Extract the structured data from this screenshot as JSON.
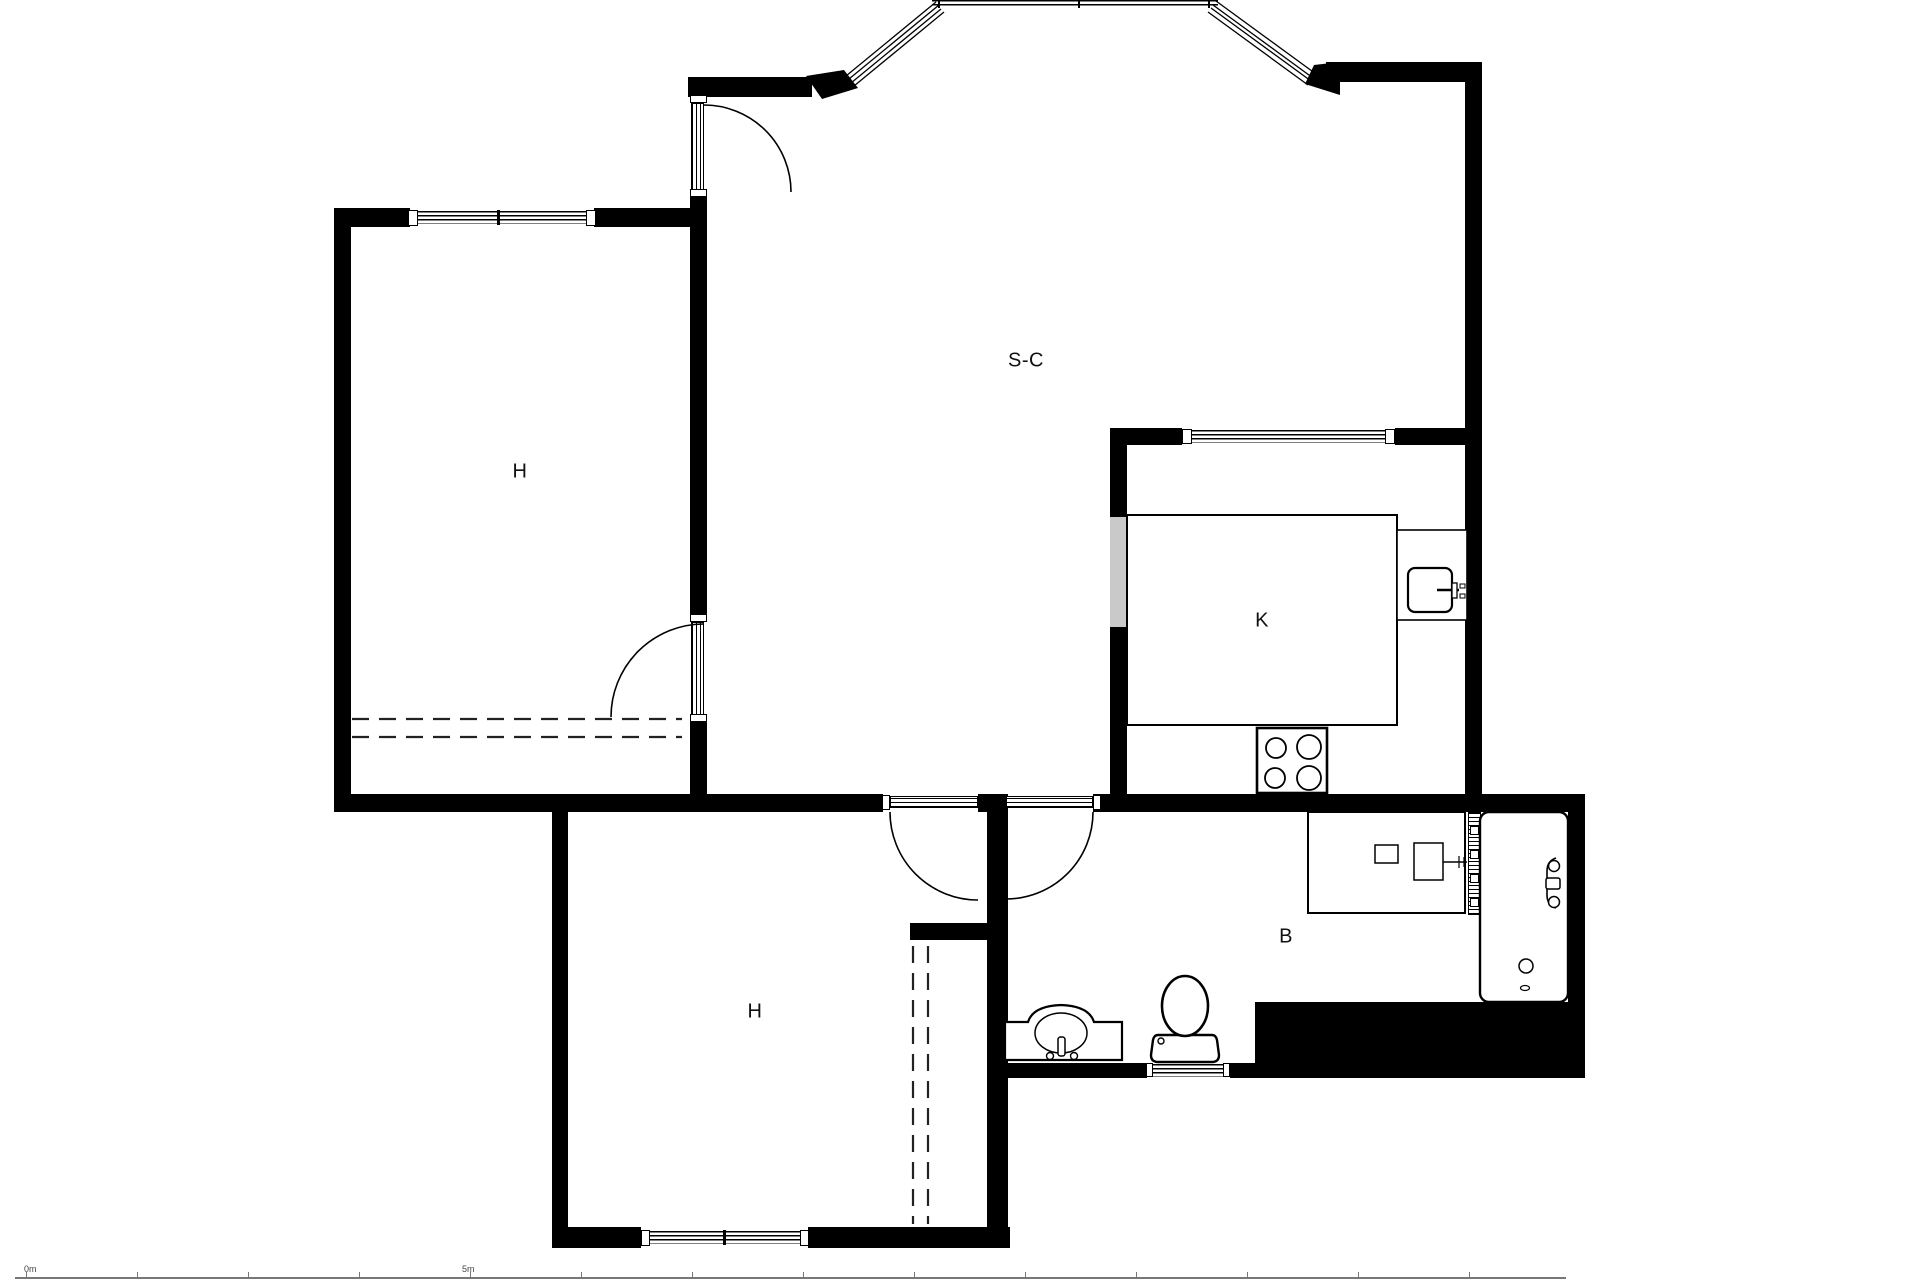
{
  "plan": {
    "type": "apartment-floor-plan",
    "rooms": [
      {
        "id": "bedroom-upper",
        "label": "H"
      },
      {
        "id": "living-room",
        "label": "S-C"
      },
      {
        "id": "kitchen",
        "label": "K"
      },
      {
        "id": "bedroom-lower",
        "label": "H"
      },
      {
        "id": "bathroom",
        "label": "B"
      }
    ],
    "fixtures": [
      "kitchen-counter",
      "kitchen-sink-icon",
      "stove-icon",
      "bathroom-vanity",
      "radiator-icon",
      "bathtub-icon",
      "toilet-icon",
      "bathroom-sink-icon",
      "wardrobe-dashed-lines",
      "door-arc",
      "window-band",
      "bay-window"
    ],
    "scale_bar": {
      "start_label": "0m",
      "end_label": "5m"
    },
    "colors": {
      "wall": "#000000",
      "background": "#ffffff",
      "opening_gray": "#c9c9c9",
      "label_text": "#111111",
      "scale_text": "#444444"
    }
  }
}
